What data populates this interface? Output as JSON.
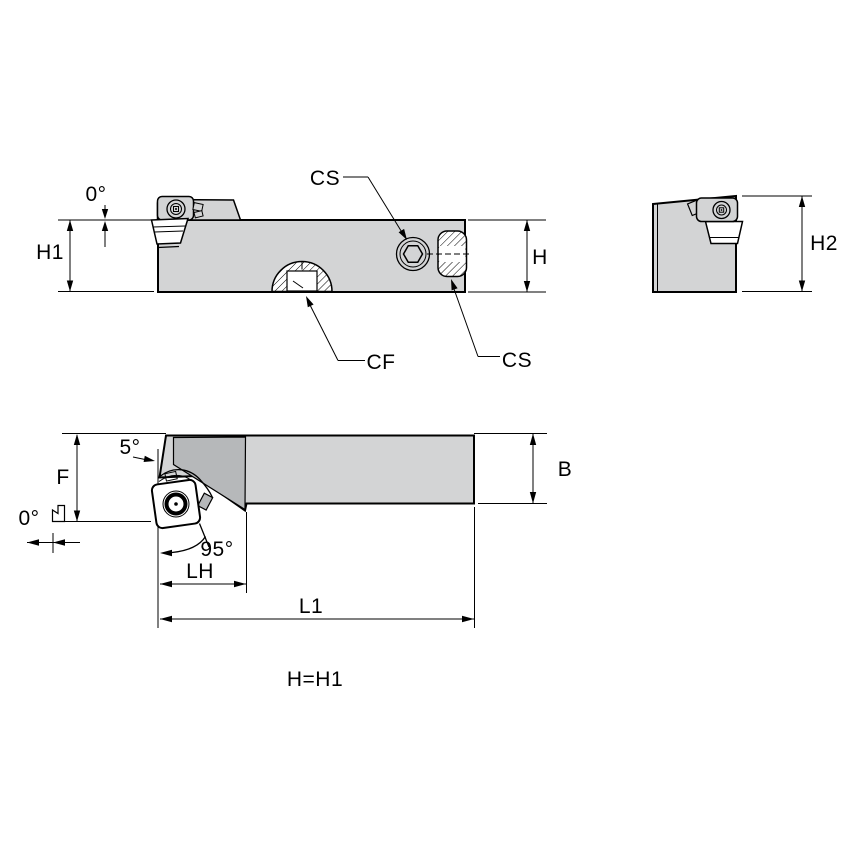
{
  "drawing": {
    "colors": {
      "body": "#d3d4d5",
      "face": "#b6b8ba",
      "outline": "#000000",
      "background": "#ffffff"
    },
    "labels": {
      "side": {
        "zero_angle": "0°",
        "h1": "H1",
        "cs_screw": "CS",
        "cs_counterbore": "CS",
        "cf": "CF",
        "h": "H"
      },
      "end": {
        "h2": "H2"
      },
      "plan": {
        "f": "F",
        "zero_angle": "0°",
        "five_angle": "5°",
        "approach_angle": "95°",
        "lh": "LH",
        "l1": "L1",
        "b": "B"
      },
      "note": "H=H1"
    }
  }
}
